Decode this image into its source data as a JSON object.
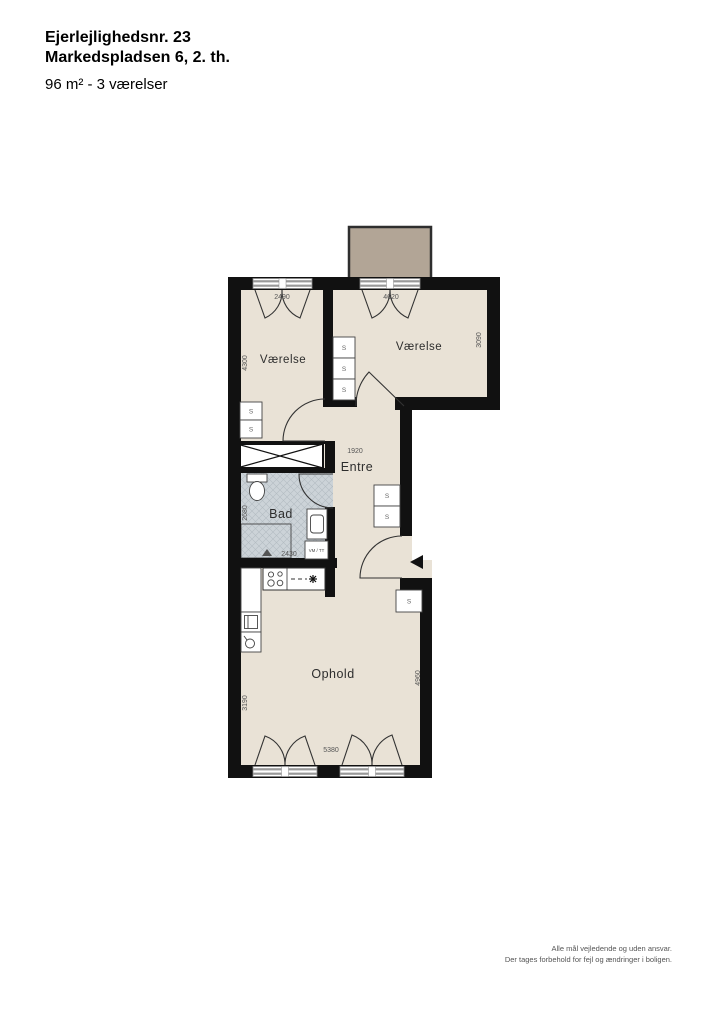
{
  "header": {
    "line1": "Ejerlejlighedsnr. 23",
    "line2": "Markedspladsen 6, 2. th.",
    "line3": "96 m² - 3 værelser"
  },
  "rooms": {
    "vaerelse1": "Værelse",
    "vaerelse2": "Værelse",
    "entre": "Entre",
    "bad": "Bad",
    "ophold": "Ophold"
  },
  "dimensions": {
    "d2490": "2490",
    "d4620": "4620",
    "d4300": "4300",
    "d3090": "3090",
    "d1920": "1920",
    "d2680": "2680",
    "d2430": "2430",
    "d3190": "3190",
    "d4960": "4960",
    "d5380": "5380"
  },
  "labels": {
    "closet": "S",
    "washer": "VM / TT"
  },
  "footer": {
    "line1": "Alle mål vejledende og uden ansvar.",
    "line2": "Der tages forbehold for fejl og ændringer i boligen."
  },
  "colors": {
    "floor": "#e9e2d6",
    "balcony": "#b2a596",
    "wall": "#111111",
    "tile": "#ccd3d8"
  }
}
